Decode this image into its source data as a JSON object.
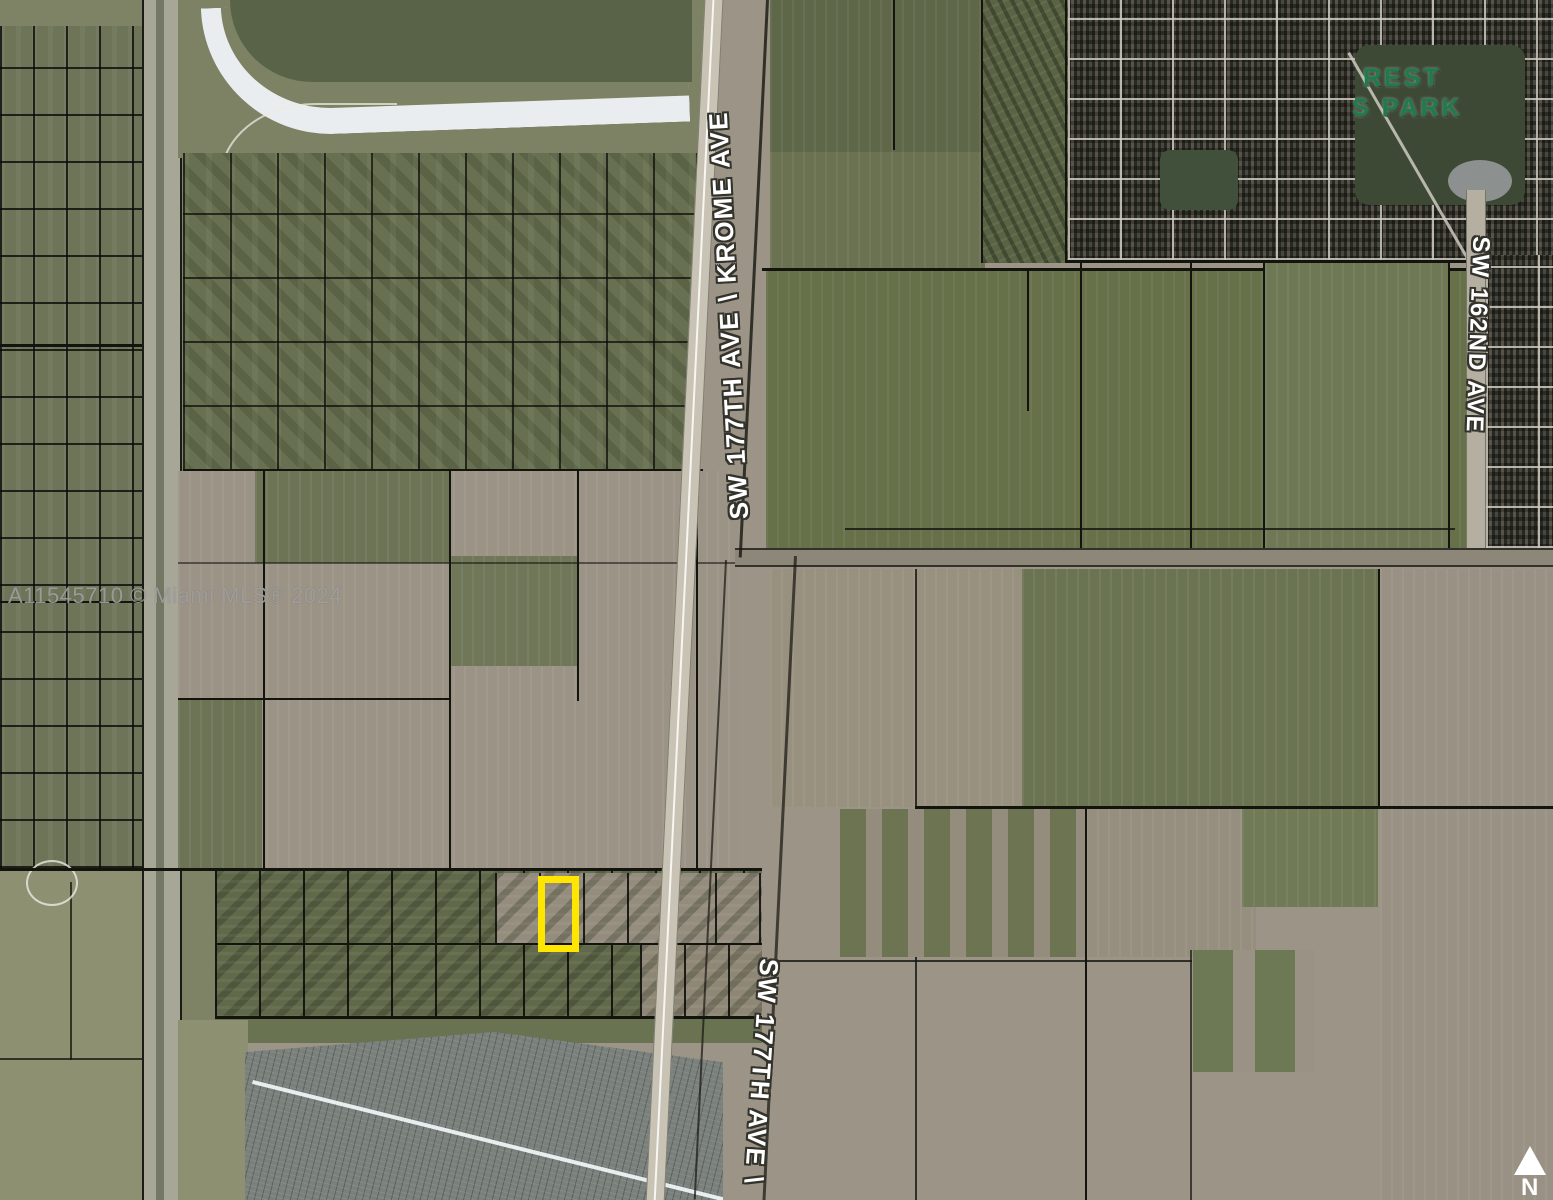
{
  "map": {
    "kind": "satellite-parcel-map",
    "watermark": "A11545710 © Miami MLS® 2024",
    "road_labels": {
      "krome": "SW 177TH AVE \\ KROME AVE",
      "sw177_south": "SW 177TH AVE \\",
      "sw162": "SW 162ND AVE"
    },
    "park_label": {
      "line1": "REST",
      "line2": "S PARK"
    },
    "north_indicator": "N",
    "colors": {
      "highlight_yellow": "#FFE600",
      "park_label_green": "#1E7B4E",
      "road_label_white": "#FFFFFF",
      "watermark_gray": "#A2A2A2",
      "parcel_line_black": "#14140F"
    }
  }
}
